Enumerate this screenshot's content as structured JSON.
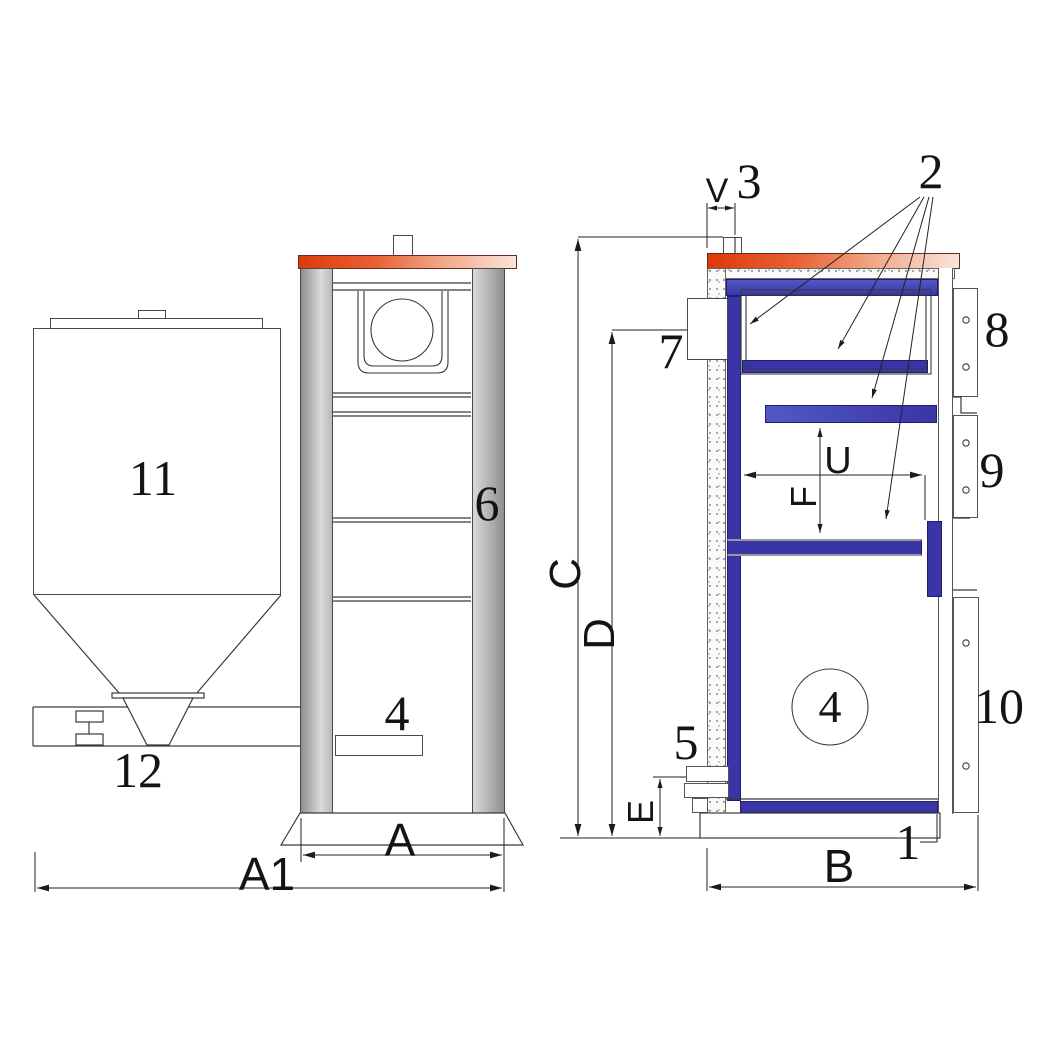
{
  "colors": {
    "line": "#3a3a3a",
    "orange": "#de3a0b",
    "orange_light": "#f8e4d9",
    "blue": "#3a35a6",
    "blue_dark": "#201d70",
    "blue_light": "#5159c4",
    "gray_dark": "#8f8f8f",
    "gray_light": "#dadada"
  },
  "part_labels": {
    "p1": "1",
    "p2": "2",
    "p3": "3",
    "p4": "4",
    "p5": "5",
    "p6": "6",
    "p7": "7",
    "p8": "8",
    "p9": "9",
    "p10": "10",
    "p11": "11",
    "p12": "12"
  },
  "dim_labels": {
    "A": "A",
    "A1": "A1",
    "B": "B",
    "C": "C",
    "D": "D",
    "E": "E",
    "F": "F",
    "U": "U",
    "V": "V"
  }
}
